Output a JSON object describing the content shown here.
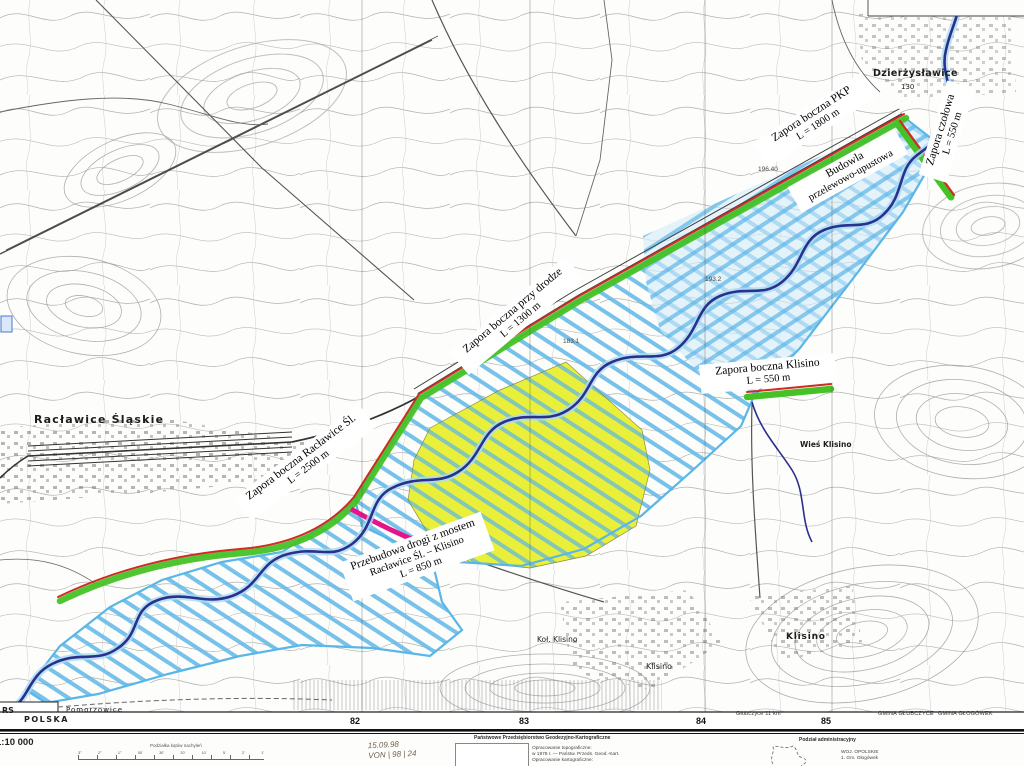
{
  "map": {
    "annotations": {
      "zapora_pkp": {
        "line1": "Zapora boczna PKP",
        "line2": "L = 1800 m"
      },
      "zapora_czolowa": {
        "line1": "Zapora czołowa",
        "line2": "L = 550 m"
      },
      "budowla": {
        "line1": "Budowla",
        "line2": "przelewowo-upustowa"
      },
      "zapora_drodze": {
        "line1": "Zapora boczna przy drodze",
        "line2": "L = 1300 m"
      },
      "zapora_raclawice": {
        "line1": "Zapora boczna Racławice Śl.",
        "line2": "L = 2500 m"
      },
      "przebudowa": {
        "line1": "Przebudowa drogi z mostem",
        "line2": "Racławice Śl. – Klisino",
        "line3": "L =  850 m"
      },
      "zapora_klisino": {
        "line1": "Zapora boczna Klisino",
        "line2": "L =  550 m"
      }
    },
    "towns": {
      "dzierzyslawice": "Dzierżysławice",
      "dzierzyslawice_height": "130",
      "raclawice": "Racławice Śląskie",
      "klisino_bold": "Klisino",
      "klisino_small": "Klisino",
      "kol_klisino": "Koł. Klisino",
      "wies_klisino": "Wieś Klisino",
      "pomorzowice": "Pomorzowice",
      "polska": "POLSKA",
      "rs": "RS"
    },
    "spot_heights": [
      "193.2",
      "183.1",
      "196.40"
    ],
    "grid_numbers": [
      "82",
      "83",
      "84",
      "85"
    ],
    "edge_labels": {
      "glubczyce_km": "Głubczyce 11 km",
      "gmina_glubczyce": "GMINA GŁUBCZYCE",
      "gmina_glogowek": "GMINA GŁOGÓWEK"
    }
  },
  "margin": {
    "scale_text": "1:10 000",
    "slope_label": "Podziałka kątów nachyleń",
    "slope_ticks": [
      "3°",
      "2°",
      "1°",
      "50'",
      "30'",
      "20'",
      "10'",
      "5'",
      "2'",
      "1'"
    ],
    "handwriting_date": "15.09.98",
    "handwriting_ref": "VON | 98 | 24",
    "ppgk_heading": "Państwowe Przedsiębiorstwo Geodezyjno-Kartograficzne",
    "ppgk_line1": "Opracowanie topograficzne:",
    "ppgk_line2": "w 1978 r. — Państw. Przeds. Geod.-Kart.",
    "ppgk_line3": "Opracowanie kartograficzne:",
    "admin_heading": "Podział administracyjny",
    "admin_line1": "WOJ. OPOLSKIE",
    "admin_line2": "1. Gm. Głogówek"
  },
  "colors": {
    "reservoir_hatch": "#5fb7e8",
    "flood_fill": "#d4ebf9",
    "polder_yellow": "#e9ef2e",
    "dam_green": "#46c226",
    "dam_red": "#d02a24",
    "river_navy": "#2b2f8e",
    "road_magenta": "#e8128a",
    "contour_gray": "#9a9a9a"
  }
}
